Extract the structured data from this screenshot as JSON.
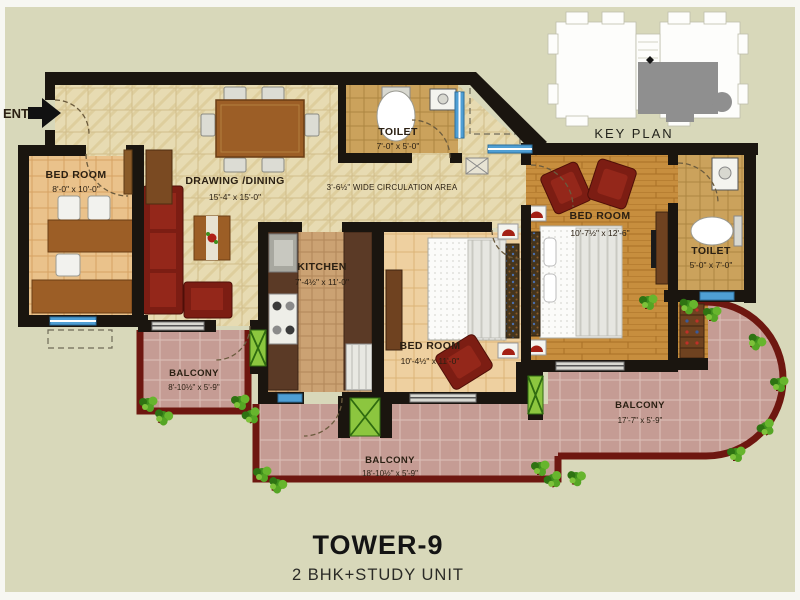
{
  "entrance": {
    "label": "ENT."
  },
  "key_plan": {
    "label": "KEY PLAN"
  },
  "rooms": {
    "study_bedroom": {
      "name": "BED ROOM",
      "dims": "8'-0\" x 10'-0\""
    },
    "drawing_dining": {
      "name": "DRAWING /DINING",
      "dims": "15'-4\" x 15'-0\""
    },
    "toilet_top": {
      "name": "TOILET",
      "dims": "7'-0\" x 5'-0\""
    },
    "kitchen": {
      "name": "KITCHEN",
      "dims": "7'-4½\" x 11'-0\""
    },
    "middle_bedroom": {
      "name": "BED ROOM",
      "dims": "10'-4½\" x 11'-0\""
    },
    "master_bedroom": {
      "name": "BED ROOM",
      "dims": "10'-7½\" x 12'-6\""
    },
    "toilet_right": {
      "name": "TOILET",
      "dims": "5'-0\" x 7'-0\""
    },
    "balcony_left": {
      "name": "BALCONY",
      "dims": "8'-10½\" x 5'-9\""
    },
    "balcony_bottom": {
      "name": "BALCONY",
      "dims": "18'-10½\" x 5'-9\""
    },
    "balcony_right": {
      "name": "BALCONY",
      "dims": "17'-7\" x 5'-9\""
    }
  },
  "circulation": {
    "label": "3'-6½\" WIDE CIRCULATION AREA"
  },
  "footer": {
    "tower": "TOWER-9",
    "unit_type": "2 BHK+STUDY UNIT"
  },
  "colors": {
    "background": "#d8d8ba",
    "wall": "#1a150f",
    "balcony_border": "#6e1710",
    "balcony_tile": "#c59c94",
    "sofa_red": "#7c1d13",
    "wood_floor": "#c78e3e",
    "marble_floor": "#e7dbb2",
    "window_blue": "#4f9fd4",
    "plant_green": "#4f9c2e",
    "keyplan_unit_gray": "#8f8f8f"
  }
}
